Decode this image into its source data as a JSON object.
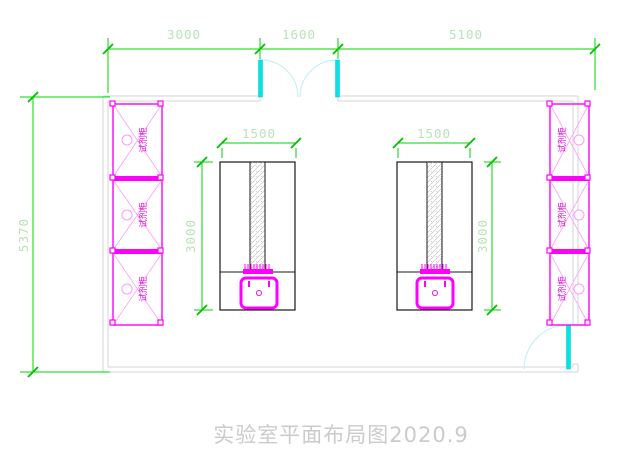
{
  "drawing": {
    "title": "实验室平面布局图2020.9",
    "dimensions": {
      "top_segments": [
        "3000",
        "1600",
        "5100"
      ],
      "room_height": "5370",
      "bench_width": "1500",
      "bench_depth": "3000"
    },
    "cabinets": {
      "label": "试剂柜",
      "left_count": 3,
      "right_count": 3
    },
    "colors": {
      "dimension_line": "#00d400",
      "dimension_text": "#b9e3b9",
      "wall": "#d6d6d6",
      "cabinet": "#ff00ff",
      "cabinet_detail": "#ff9bff",
      "door_leaf": "#00e6e6",
      "door_swing": "#c0eeee",
      "bench_outline": "#181818",
      "hatch": "#b0b0b0",
      "title_text": "#cbcbcb"
    }
  }
}
